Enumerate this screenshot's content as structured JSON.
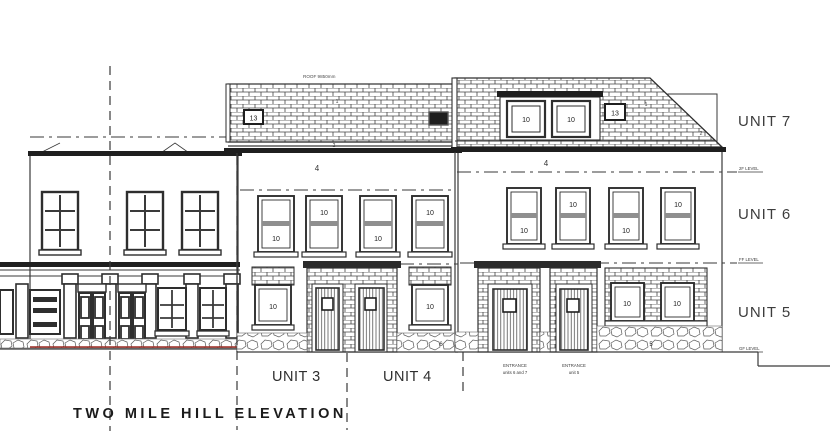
{
  "title": "TWO MILE HILL ELEVATION",
  "roof_note": "ROOF 9850mm",
  "units": {
    "u3": "UNIT 3",
    "u4": "UNIT 4",
    "u5": "UNIT 5",
    "u6": "UNIT 6",
    "u7": "UNIT 7"
  },
  "levels": {
    "second": "2F LEVEL",
    "first": "FF LEVEL",
    "ground": "GF LEVEL"
  },
  "tags": {
    "window": "10",
    "rooflight": "13",
    "wall": "4",
    "plinth": "6",
    "stone": "5",
    "slate": "1",
    "eaves": "2"
  },
  "entrances": {
    "units67": {
      "line1": "ENTRANCE",
      "line2": "units 6 and 7"
    },
    "unit5": {
      "line1": "ENTRANCE",
      "line2": "unit 5"
    }
  },
  "colors": {
    "line": "#3a3a3a",
    "dark_fill": "#1f1f1f",
    "sash_rail": "#8f8f8f",
    "accent_red": "#9c2b23",
    "background": "#ffffff"
  }
}
